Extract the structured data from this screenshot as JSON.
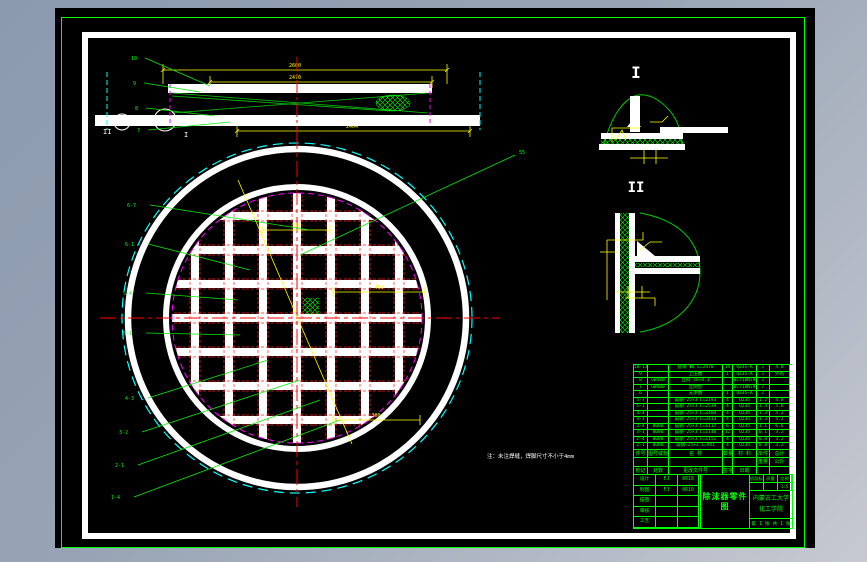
{
  "note": "注：未注焊缝，焊脚尺寸不小于4mm",
  "labels": {
    "detail_i": "I",
    "detail_ii": "II",
    "section_marker_ii": "II",
    "section_marker_i": "I",
    "leader_55": "55"
  },
  "dims": {
    "d2600": "2600",
    "d2470": "2470",
    "d2404": "2404",
    "d380": "380",
    "d450": "450",
    "d300": "300"
  },
  "balloons_top": [
    "10",
    "9",
    "8",
    "7"
  ],
  "balloons_main": [
    "6-7",
    "6-1",
    "5-4",
    "5-1",
    "4-3",
    "3-2",
    "2-1",
    "1-4"
  ],
  "bom": {
    "rows": [
      [
        "10-13",
        "",
        "圆钢 Φ8 L=2470",
        "14",
        "Q235-A",
        "/",
        "4.8"
      ],
      [
        "9",
        "",
        "上压圈",
        "1",
        "Q235-A",
        "/",
        "外购"
      ],
      [
        "8",
        "GW300",
        "丝网 40×0.3",
        "",
        "0Cr18Ni9",
        "/",
        ""
      ],
      [
        "7",
        "GW300",
        "丝网垫",
        "",
        "0Cr18Ni9",
        "/",
        ""
      ],
      [
        "6",
        "",
        "支承圈",
        "1",
        "Q235-A",
        "/",
        ""
      ],
      [
        "5-7",
        "",
        "扁钢-25×3 L=2193",
        "4",
        "Q235",
        "1.2",
        "4.8"
      ],
      [
        "5-1",
        "",
        "扁钢-25×3 L=2539",
        "4",
        "Q235",
        "1.4",
        "5.6"
      ],
      [
        "4-4",
        "",
        "扁钢-25×3 L=2404",
        "4",
        "Q235",
        "1.3",
        "5.2"
      ],
      [
        "4-1",
        "",
        "扁钢-25×3 L=2413",
        "4",
        "Q235",
        "1.3",
        "5.2"
      ],
      [
        "3-4",
        "0000",
        "扁钢-25×3 L=1117",
        "6",
        "Q235",
        "1.1",
        "6.6"
      ],
      [
        "3-1",
        "0000",
        "扁钢-25×3 L=1140",
        "32",
        "Q235",
        "0.1",
        "3.2"
      ],
      [
        "2-4",
        "0000",
        "扁钢-25×3 L=1151",
        "4",
        "Q235",
        "0.8",
        "3.2"
      ],
      [
        "2-1",
        "0000",
        "扁钢-25×3 L=951",
        "4",
        "Q235",
        "0.8",
        "3.2"
      ]
    ],
    "headers": [
      [
        "件号",
        "图号或标准号",
        "名  称",
        "数量",
        "材 料",
        "单件",
        "总计"
      ],
      [
        "",
        "",
        "",
        "",
        "",
        "重量",
        "公斤"
      ],
      [
        "标记",
        "处数",
        "更改文件号",
        "签字",
        "日期",
        "",
        ""
      ]
    ]
  },
  "title_block": {
    "title": "除沫器零件图",
    "org_line1": "内蒙古工大学",
    "org_line2": "化工学院",
    "sheet": "第 1 张  共 1 张",
    "left_rows": [
      [
        "设计",
        "FJ",
        "0610"
      ],
      [
        "制图",
        "FJ",
        "0610"
      ],
      [
        "描图",
        "",
        ""
      ],
      [
        "审核",
        "",
        ""
      ],
      [
        "工艺",
        "",
        ""
      ]
    ],
    "right_top": [
      "阶段标记",
      "质量",
      "比例"
    ],
    "right_top2": [
      "",
      "",
      "1:5"
    ]
  }
}
